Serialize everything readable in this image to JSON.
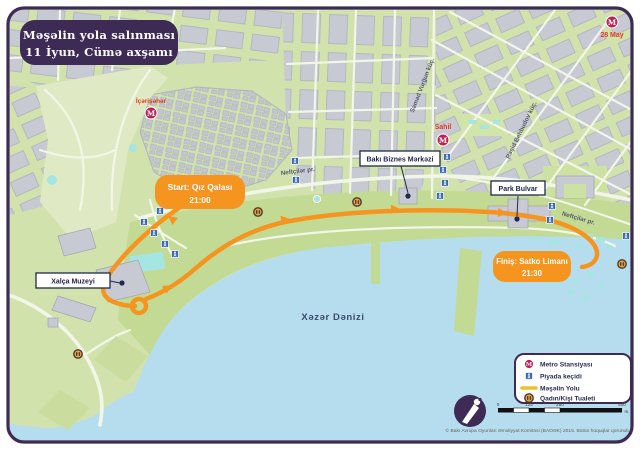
{
  "title": {
    "line1": "Məşəlin yola salınması",
    "line2": "11 İyun, Cümə axşamı"
  },
  "start_marker": {
    "line1": "Start: Qız Qalası",
    "line2": "21:00"
  },
  "finish_marker": {
    "line1": "Finiş: Satko Limanı",
    "line2": "21:30"
  },
  "metro": {
    "icherisheher": "İçərişəhər",
    "sahil": "Sahil",
    "may28": "28 May"
  },
  "poi": {
    "business_center": "Bakı Biznes Mərkəzi",
    "park_bulvar": "Park Bulvar",
    "carpet_museum": "Xalça Muzeyi"
  },
  "streets": {
    "neftchilar_west": "Neftçilər pr.",
    "neftchilar_east": "Neftçilər pr.",
    "samad_vurgun": "Səməd Vurğun küç.",
    "rashid_behbudov": "Rəşid Behbudov küç."
  },
  "sea_label": "Xəzər Dənizi",
  "icons": {
    "metro_letter": "M"
  },
  "legend": {
    "items": [
      {
        "icon": "metro-icon",
        "label": "Metro Stansiyası"
      },
      {
        "icon": "pedestrian-crossing-icon",
        "label": "Piyada keçidi"
      },
      {
        "icon": "route-line",
        "label": "Məşəlin Yolu"
      },
      {
        "icon": "toilet-icon",
        "label": "Qadın/Kişi Tualeti"
      }
    ]
  },
  "scalebar": {
    "ticks": [
      "0",
      "125",
      "250",
      "500"
    ],
    "unit": "m."
  },
  "footer": {
    "copyright": "© Bakı Avropa Oyunları Əməliyyat Komitəsi (BAOƏK) 2015. Bütün hüquqlar qorunub"
  },
  "colors": {
    "accent_purple": "#3D2A55",
    "route_orange": "#F5941F",
    "metro_magenta": "#C41E56",
    "crossing_blue": "#3B68AE",
    "toilet_orange": "#F0A43C",
    "legend_route_yellow": "#EFBF2A",
    "label_red": "#E23A1F",
    "sea_blue": "#B6DDEE",
    "land_green": "#D2E2AD"
  }
}
